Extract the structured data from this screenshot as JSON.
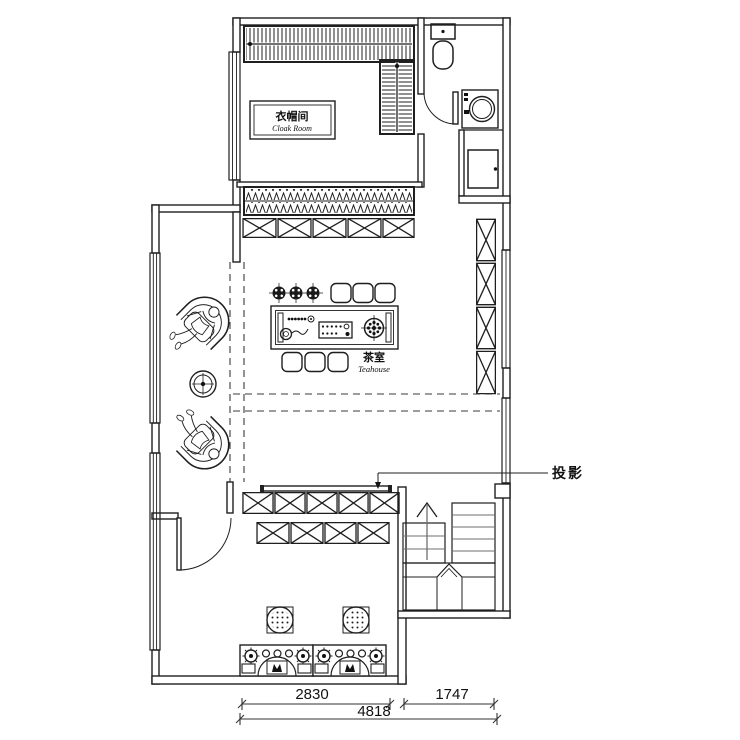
{
  "meta": {
    "drawing_type": "floor-plan",
    "background_color": "#ffffff",
    "line_color": "#1f1f1f",
    "secondary_line_color": "#6f6f6f"
  },
  "rooms": {
    "cloak_room": {
      "name_zh": "衣帽间",
      "name_en": "Cloak Room"
    },
    "tea_room": {
      "name_zh": "茶室",
      "name_en": "Teahouse"
    }
  },
  "annotations": {
    "projection": {
      "label": "投影"
    }
  },
  "dimensions": {
    "left": "2830",
    "right": "1747",
    "total": "4818"
  }
}
